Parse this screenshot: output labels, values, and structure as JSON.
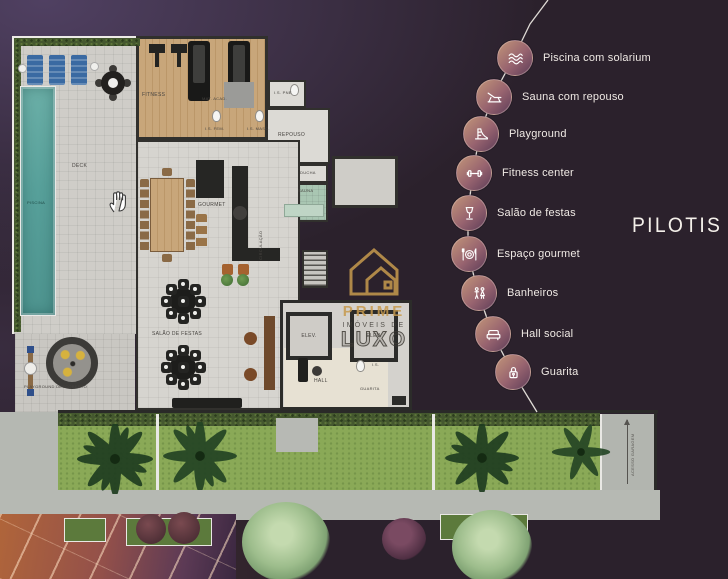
{
  "page_title": "PILOTIS",
  "legend": {
    "items": [
      {
        "label": "Piscina com solarium",
        "icon": "waves-icon"
      },
      {
        "label": "Sauna com repouso",
        "icon": "lounger-icon"
      },
      {
        "label": "Playground",
        "icon": "slide-icon"
      },
      {
        "label": "Fitness center",
        "icon": "dumbbell-icon"
      },
      {
        "label": "Salão de festas",
        "icon": "glass-icon"
      },
      {
        "label": "Espaço gourmet",
        "icon": "cutlery-plate-icon"
      },
      {
        "label": "Banheiros",
        "icon": "restroom-icon"
      },
      {
        "label": "Hall social",
        "icon": "sofa-icon"
      },
      {
        "label": "Guarita",
        "icon": "lock-guard-icon"
      }
    ]
  },
  "floorplan": {
    "labels": {
      "piscina": "PISCINA",
      "deck": "DECK",
      "fitness": "FITNESS",
      "mat_acad": "MAT. ACAD.",
      "is_fem": "I.S. FEM.",
      "is_masc": "I.S. MASC.",
      "is_pne": "I.S. PNE",
      "repouso": "REPOUSO",
      "ducha": "DUCHA",
      "sauna": "SAUNA",
      "gourmet": "GOURMET",
      "circulacao": "CIRCULAÇÃO",
      "salao_de_festas": "SALÃO DE FESTAS",
      "elevador": "ELEV.",
      "hall": "HALL",
      "is": "I.S.",
      "guarita": "GUARITA",
      "playground_descoberto": "PLAYGROUND DESCOBERTO",
      "acesso_garagem": "ACESSO GARAGEM"
    }
  },
  "watermark": {
    "brand": "PRIME",
    "tagline_top": "IMÓVEIS DE",
    "tagline_bottom": "LUXO"
  },
  "colors": {
    "background": "#2b212c",
    "legend-from": "#c29579",
    "legend-mid": "#97636f",
    "legend-to": "#5e3d58",
    "legend-text": "#efe9e4",
    "title-text": "#f4f0ea",
    "pool": "#5ea69f",
    "accent-gold": "#c79a4e"
  }
}
